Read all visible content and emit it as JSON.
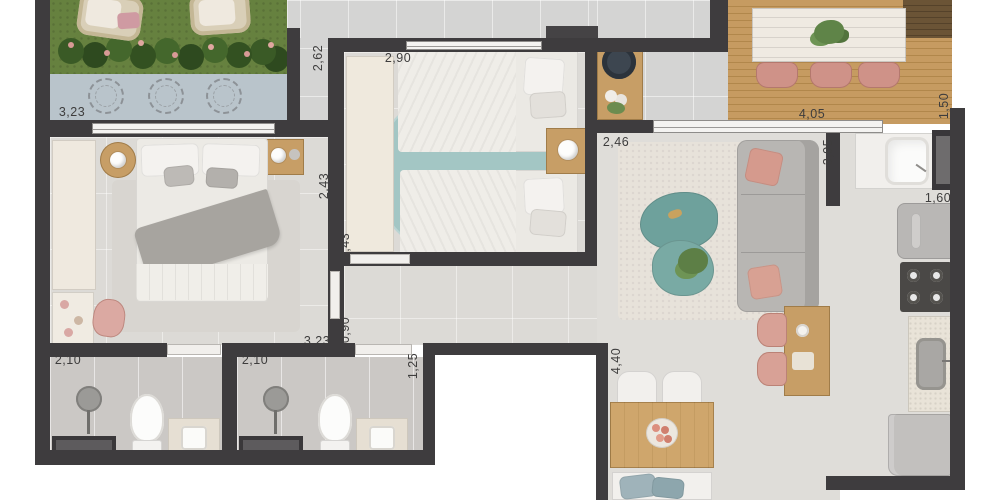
{
  "plan": {
    "type": "apartment-floorplan-render",
    "unit": "meters",
    "dimension_labels": [
      {
        "id": "garden-width",
        "value": "3,23",
        "cx": 72,
        "cy": 112,
        "orientation": "horizontal"
      },
      {
        "id": "garden-side-depth",
        "value": "2,62",
        "cx": 318,
        "cy": 58,
        "orientation": "vertical"
      },
      {
        "id": "bedroom2-width",
        "value": "2,90",
        "cx": 398,
        "cy": 58,
        "orientation": "horizontal"
      },
      {
        "id": "hall-width",
        "value": "2,46",
        "cx": 616,
        "cy": 142,
        "orientation": "horizontal"
      },
      {
        "id": "balcony-width",
        "value": "4,05",
        "cx": 812,
        "cy": 114,
        "orientation": "horizontal"
      },
      {
        "id": "balcony-depth",
        "value": "1,50",
        "cx": 944,
        "cy": 106,
        "orientation": "vertical"
      },
      {
        "id": "living-depth",
        "value": "3,95",
        "cx": 828,
        "cy": 152,
        "orientation": "vertical"
      },
      {
        "id": "bedroom1-depth-a",
        "value": "2,43",
        "cx": 324,
        "cy": 186,
        "orientation": "vertical"
      },
      {
        "id": "bedroom1-depth-b",
        "value": "2,43",
        "cx": 345,
        "cy": 246,
        "orientation": "vertical"
      },
      {
        "id": "kitchen-width",
        "value": "1,60",
        "cx": 938,
        "cy": 198,
        "orientation": "horizontal"
      },
      {
        "id": "hall-passage",
        "value": "0,90",
        "cx": 345,
        "cy": 330,
        "orientation": "vertical"
      },
      {
        "id": "bedroom1-width",
        "value": "3,23",
        "cx": 317,
        "cy": 341,
        "orientation": "horizontal"
      },
      {
        "id": "bath1-width",
        "value": "2,10",
        "cx": 68,
        "cy": 360,
        "orientation": "horizontal"
      },
      {
        "id": "bath2-width",
        "value": "2,10",
        "cx": 255,
        "cy": 360,
        "orientation": "horizontal"
      },
      {
        "id": "bath1-door",
        "value": "1,25",
        "cx": 228,
        "cy": 369,
        "orientation": "vertical"
      },
      {
        "id": "bath2-door",
        "value": "1,25",
        "cx": 413,
        "cy": 366,
        "orientation": "vertical"
      },
      {
        "id": "dining-depth",
        "value": "4,40",
        "cx": 616,
        "cy": 361,
        "orientation": "vertical"
      }
    ],
    "colors": {
      "wall": "#3e3c3e",
      "grass": "#66813f",
      "paving": "#b9c4cb",
      "deck_wood": "#c69b61",
      "floor_light": "#dcdad6",
      "floor_bath": "#cbc8c5",
      "rug_teal": "#a3c6c4",
      "accent_salmon": "#d59a8d",
      "coffee_table_teal": "#6ea19c",
      "furniture_wood": "#c79e66",
      "sofa_gray": "#b8b6b3",
      "label_text": "#3e3d3d"
    }
  }
}
